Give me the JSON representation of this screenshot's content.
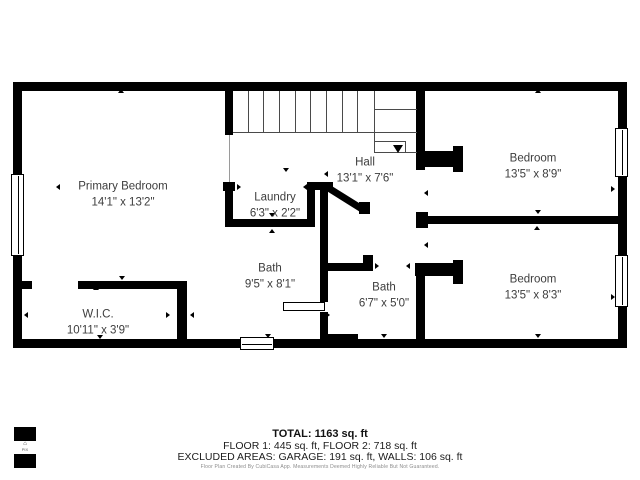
{
  "plan": {
    "rooms": [
      {
        "name": "Primary Bedroom",
        "dims": "14'1\" x 13'2\""
      },
      {
        "name": "Hall",
        "dims": "13'1\" x 7'6\""
      },
      {
        "name": "Laundry",
        "dims": "6'3\" x 2'2\""
      },
      {
        "name": "Bedroom",
        "dims": "13'5\" x 8'9\""
      },
      {
        "name": "Bath",
        "dims": "9'5\" x 8'1\""
      },
      {
        "name": "Bath",
        "dims": "6'7\" x 5'0\""
      },
      {
        "name": "Bedroom",
        "dims": "13'5\" x 8'3\""
      },
      {
        "name": "W.I.C.",
        "dims": "10'11\" x 3'9\""
      }
    ],
    "wall_color": "#000000",
    "label_color": "#3d3d3d"
  },
  "footer": {
    "total": "TOTAL: 1163 sq. ft",
    "floors": "FLOOR 1: 445 sq. ft, FLOOR 2: 718 sq. ft",
    "excluded": "EXCLUDED AREAS: GARAGE: 191 sq. ft, WALLS: 106 sq. ft",
    "disclaimer": "Floor Plan Created By CubiCasa App. Measurements Deemed Highly Reliable But Not Guaranteed."
  },
  "logo": {
    "text": "PIX",
    "house_glyph": "⌂"
  }
}
